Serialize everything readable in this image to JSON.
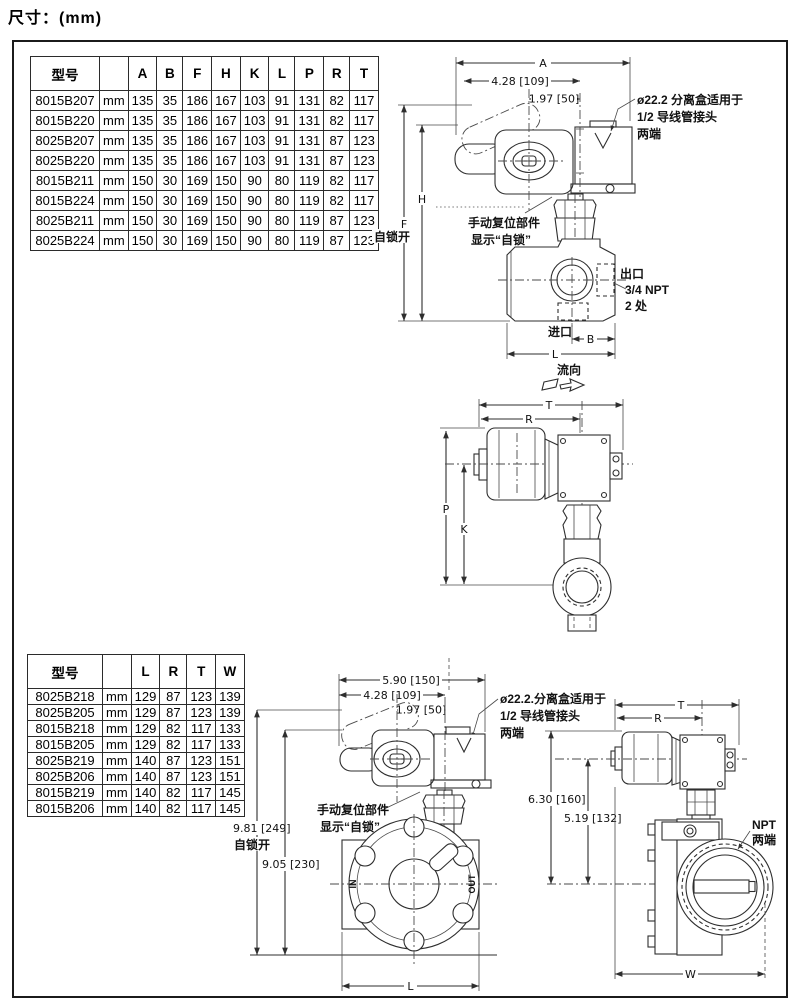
{
  "page": {
    "title": "尺寸：(mm)"
  },
  "tables": {
    "top": {
      "headers": [
        "型号",
        "",
        "A",
        "B",
        "F",
        "H",
        "K",
        "L",
        "P",
        "R",
        "T"
      ],
      "rows": [
        [
          "8015B207",
          "mm",
          "135",
          "35",
          "186",
          "167",
          "103",
          "91",
          "131",
          "82",
          "117"
        ],
        [
          "8015B220",
          "mm",
          "135",
          "35",
          "186",
          "167",
          "103",
          "91",
          "131",
          "82",
          "117"
        ],
        [
          "8025B207",
          "mm",
          "135",
          "35",
          "186",
          "167",
          "103",
          "91",
          "131",
          "87",
          "123"
        ],
        [
          "8025B220",
          "mm",
          "135",
          "35",
          "186",
          "167",
          "103",
          "91",
          "131",
          "87",
          "123"
        ],
        [
          "8015B211",
          "mm",
          "150",
          "30",
          "169",
          "150",
          "90",
          "80",
          "119",
          "82",
          "117"
        ],
        [
          "8015B224",
          "mm",
          "150",
          "30",
          "169",
          "150",
          "90",
          "80",
          "119",
          "82",
          "117"
        ],
        [
          "8025B211",
          "mm",
          "150",
          "30",
          "169",
          "150",
          "90",
          "80",
          "119",
          "87",
          "123"
        ],
        [
          "8025B224",
          "mm",
          "150",
          "30",
          "169",
          "150",
          "90",
          "80",
          "119",
          "87",
          "123"
        ]
      ]
    },
    "bottom": {
      "headers": [
        "型号",
        "",
        "L",
        "R",
        "T",
        "W"
      ],
      "rows": [
        [
          "8025B218",
          "mm",
          "129",
          "87",
          "123",
          "139"
        ],
        [
          "8025B205",
          "mm",
          "129",
          "87",
          "123",
          "139"
        ],
        [
          "8015B218",
          "mm",
          "129",
          "82",
          "117",
          "133"
        ],
        [
          "8015B205",
          "mm",
          "129",
          "82",
          "117",
          "133"
        ],
        [
          "8025B219",
          "mm",
          "140",
          "87",
          "123",
          "151"
        ],
        [
          "8025B206",
          "mm",
          "140",
          "87",
          "123",
          "151"
        ],
        [
          "8015B219",
          "mm",
          "140",
          "82",
          "117",
          "145"
        ],
        [
          "8015B206",
          "mm",
          "140",
          "82",
          "117",
          "145"
        ]
      ]
    }
  },
  "drawing_top": {
    "dims": {
      "a": "A",
      "d428": "4.28  [109]",
      "d197": "1.97  [50]",
      "h": "H",
      "f": "F",
      "b": "B",
      "l": "L"
    },
    "labels": {
      "selflock_open": "自锁开",
      "conduit_note_1": "ø22.2 分离盒适用于",
      "conduit_note_2": "1/2 导线管接头",
      "conduit_note_3": "两端",
      "manual_reset_1": "手动复位部件",
      "manual_reset_2": "显示“自锁”",
      "outlet": "出口",
      "outlet_npt": "3/4 NPT",
      "outlet_places": "2 处",
      "inlet": "进口",
      "flow": "流向"
    }
  },
  "drawing_side": {
    "dims": {
      "t": "T",
      "r": "R",
      "p": "P",
      "k": "K"
    }
  },
  "drawing_bottom_front": {
    "dims": {
      "d590": "5.90  [150]",
      "d428": "4.28  [109]",
      "d197": "1.97  [50]",
      "d981": "9.81 [249]",
      "d905": "9.05 [230]",
      "l": "L"
    },
    "labels": {
      "conduit_note_1": "ø22.2.分离盒适用于",
      "conduit_note_2": "1/2 导线管接头",
      "conduit_note_3": "两端",
      "manual_reset_1": "手动复位部件",
      "manual_reset_2": "显示“自锁”",
      "selflock_open": "自锁开",
      "in": "IN",
      "out": "OUT"
    }
  },
  "drawing_bottom_side": {
    "dims": {
      "t": "T",
      "r": "R",
      "d630": "6.30  [160]",
      "d519": "5.19  [132]",
      "w": "W"
    },
    "labels": {
      "npt_1": "NPT",
      "npt_2": "两端"
    }
  }
}
